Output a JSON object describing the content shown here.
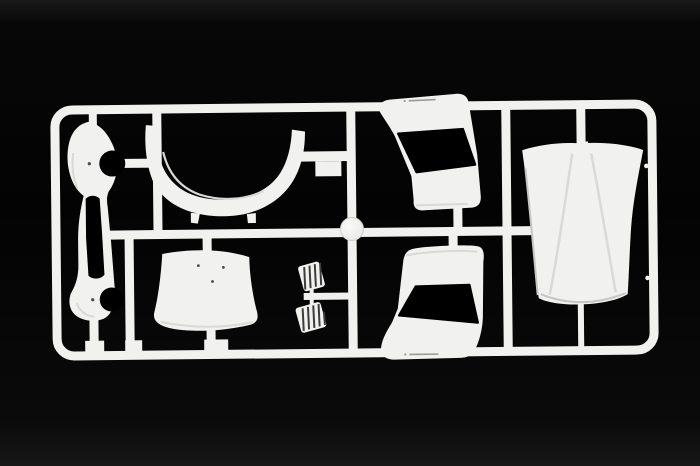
{
  "image": {
    "type": "photograph",
    "description": "White injection-molded model kit sprue (parts tree) with car body parts, photographed on a black background",
    "orientation": "landscape"
  },
  "colors": {
    "background": "#050505",
    "plastic": "#f1f1ef",
    "plastic-shade": "#d9d9d7",
    "plastic-deep": "#c6c6c4",
    "cutout": "#000000",
    "detail-dot": "#4a4a48",
    "molded-text": "#9a9a98"
  },
  "sprue": {
    "frame": "rounded rectangular runner frame",
    "material": "white polystyrene",
    "label": "model kit sprue with car body parts"
  },
  "parts": [
    {
      "id": "bumper-panel",
      "label": "vertical bumper panel with slot and two round notches"
    },
    {
      "id": "arch-part",
      "label": "curved U-shaped arch (valance / windscreen frame)"
    },
    {
      "id": "cowl-panel",
      "label": "small curved bonnet / cowl panel with three pin marks"
    },
    {
      "id": "pedal-set",
      "label": "pair of ribbed pedals on a short runner"
    },
    {
      "id": "upper-side-panel",
      "label": "upper body side panel with black window opening and molded text"
    },
    {
      "id": "lower-side-panel",
      "label": "lower body side panel with black window opening and molded text"
    },
    {
      "id": "engine-cover",
      "label": "large engine cover / hood with twin ridges"
    },
    {
      "id": "round-cap",
      "label": "small round disc at runner junction"
    }
  ]
}
